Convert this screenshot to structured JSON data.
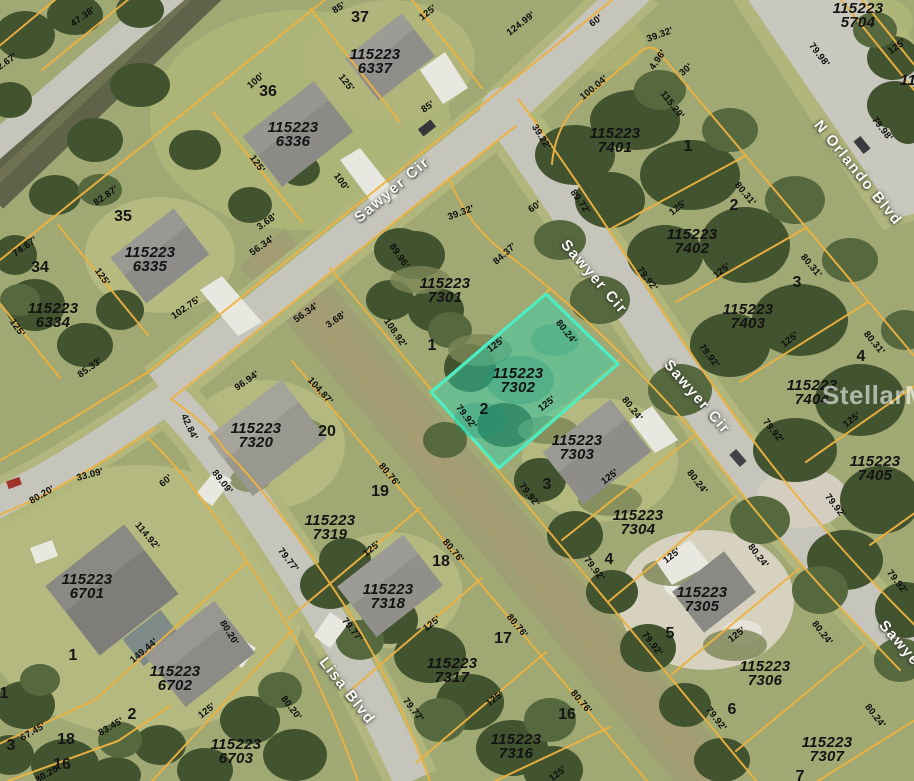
{
  "map": {
    "watermark": "StellarMLS",
    "highlighted_parcel": "115223 7302",
    "colors": {
      "parcel_line": "#eeb240",
      "highlight_fill": "rgba(45,212,180,0.45)",
      "highlight_border": "#49efc7",
      "road": "#c6c5bc"
    },
    "streets": [
      {
        "t": "Sawyer Cir",
        "x": 392,
        "y": 190,
        "r": -40
      },
      {
        "t": "Sawyer Cir",
        "x": 594,
        "y": 277,
        "r": 49
      },
      {
        "t": "Sawyer Cir",
        "x": 697,
        "y": 397,
        "r": 49
      },
      {
        "t": "Sawyer",
        "x": 902,
        "y": 646,
        "r": 49
      },
      {
        "t": "Lisa Blvd",
        "x": 347,
        "y": 691,
        "r": 52
      },
      {
        "t": "N Orlando Blvd",
        "x": 858,
        "y": 173,
        "r": 51
      }
    ],
    "parcel_ids": [
      {
        "t": "115223 6337",
        "x": 375,
        "y": 62
      },
      {
        "t": "115223 6336",
        "x": 293,
        "y": 135
      },
      {
        "t": "115223 6335",
        "x": 150,
        "y": 260
      },
      {
        "t": "115223 6334",
        "x": 53,
        "y": 316
      },
      {
        "t": "115223 5704",
        "x": 858,
        "y": 16
      },
      {
        "t": "11",
        "x": 908,
        "y": 81
      },
      {
        "t": "115223 7401",
        "x": 615,
        "y": 141
      },
      {
        "t": "115223 7402",
        "x": 692,
        "y": 242
      },
      {
        "t": "115223 7403",
        "x": 748,
        "y": 317
      },
      {
        "t": "115223 7404",
        "x": 812,
        "y": 393
      },
      {
        "t": "115223 7405",
        "x": 875,
        "y": 469
      },
      {
        "t": "115223 7301",
        "x": 445,
        "y": 291
      },
      {
        "t": "115223 7302",
        "x": 518,
        "y": 381
      },
      {
        "t": "115223 7303",
        "x": 577,
        "y": 448
      },
      {
        "t": "115223 7304",
        "x": 638,
        "y": 523
      },
      {
        "t": "115223 7305",
        "x": 702,
        "y": 600
      },
      {
        "t": "115223 7306",
        "x": 765,
        "y": 674
      },
      {
        "t": "115223 7307",
        "x": 827,
        "y": 750
      },
      {
        "t": "115223 7320",
        "x": 256,
        "y": 436
      },
      {
        "t": "115223 7319",
        "x": 330,
        "y": 528
      },
      {
        "t": "115223 7318",
        "x": 388,
        "y": 597
      },
      {
        "t": "115223 7317",
        "x": 452,
        "y": 671
      },
      {
        "t": "115223 7316",
        "x": 516,
        "y": 747
      },
      {
        "t": "115223 6701",
        "x": 87,
        "y": 587
      },
      {
        "t": "115223 6702",
        "x": 175,
        "y": 679
      },
      {
        "t": "115223 6703",
        "x": 236,
        "y": 752
      }
    ],
    "lot_numbers": [
      {
        "t": "37",
        "x": 360,
        "y": 18
      },
      {
        "t": "36",
        "x": 268,
        "y": 92
      },
      {
        "t": "35",
        "x": 123,
        "y": 217
      },
      {
        "t": "34",
        "x": 40,
        "y": 268
      },
      {
        "t": "1",
        "x": 688,
        "y": 147
      },
      {
        "t": "2",
        "x": 734,
        "y": 206
      },
      {
        "t": "3",
        "x": 797,
        "y": 283
      },
      {
        "t": "4",
        "x": 861,
        "y": 357
      },
      {
        "t": "1",
        "x": 432,
        "y": 346
      },
      {
        "t": "2",
        "x": 484,
        "y": 410
      },
      {
        "t": "3",
        "x": 547,
        "y": 485
      },
      {
        "t": "4",
        "x": 609,
        "y": 560
      },
      {
        "t": "5",
        "x": 670,
        "y": 634
      },
      {
        "t": "6",
        "x": 732,
        "y": 710
      },
      {
        "t": "7",
        "x": 800,
        "y": 777
      },
      {
        "t": "20",
        "x": 327,
        "y": 432
      },
      {
        "t": "19",
        "x": 380,
        "y": 492
      },
      {
        "t": "18",
        "x": 441,
        "y": 562
      },
      {
        "t": "17",
        "x": 503,
        "y": 639
      },
      {
        "t": "16",
        "x": 567,
        "y": 715
      },
      {
        "t": "1",
        "x": 73,
        "y": 656
      },
      {
        "t": "2",
        "x": 132,
        "y": 715
      },
      {
        "t": "18",
        "x": 66,
        "y": 740
      },
      {
        "t": "16",
        "x": 62,
        "y": 765
      },
      {
        "t": "3",
        "x": 11,
        "y": 746
      },
      {
        "t": "1",
        "x": 4,
        "y": 694
      }
    ],
    "measurements": [
      {
        "t": "47.38'",
        "x": 83,
        "y": 17,
        "r": -35
      },
      {
        "t": "2.67'",
        "x": 7,
        "y": 62,
        "r": -35
      },
      {
        "t": "85'",
        "x": 339,
        "y": 8,
        "r": -32
      },
      {
        "t": "125'",
        "x": 428,
        "y": 13,
        "r": -38
      },
      {
        "t": "124.99'",
        "x": 521,
        "y": 24,
        "r": -38
      },
      {
        "t": "60'",
        "x": 596,
        "y": 21,
        "r": -36
      },
      {
        "t": "39.32'",
        "x": 660,
        "y": 35,
        "r": -20
      },
      {
        "t": "100'",
        "x": 256,
        "y": 81,
        "r": -40
      },
      {
        "t": "125'",
        "x": 346,
        "y": 83,
        "r": 52
      },
      {
        "t": "85'",
        "x": 428,
        "y": 107,
        "r": -35
      },
      {
        "t": "100'",
        "x": 341,
        "y": 182,
        "r": 55
      },
      {
        "t": "125'",
        "x": 257,
        "y": 164,
        "r": 55
      },
      {
        "t": "82.87'",
        "x": 106,
        "y": 196,
        "r": -35
      },
      {
        "t": "3.68'",
        "x": 267,
        "y": 222,
        "r": -35
      },
      {
        "t": "56.34'",
        "x": 262,
        "y": 246,
        "r": -35
      },
      {
        "t": "74.67'",
        "x": 25,
        "y": 247,
        "r": -35
      },
      {
        "t": "125'",
        "x": 102,
        "y": 277,
        "r": 55
      },
      {
        "t": "102.75'",
        "x": 186,
        "y": 308,
        "r": -35
      },
      {
        "t": "125'",
        "x": 17,
        "y": 328,
        "r": 55
      },
      {
        "t": "85.33'",
        "x": 90,
        "y": 368,
        "r": -35
      },
      {
        "t": "56.34'",
        "x": 306,
        "y": 313,
        "r": -35
      },
      {
        "t": "3.68'",
        "x": 336,
        "y": 320,
        "r": -35
      },
      {
        "t": "4.96'",
        "x": 658,
        "y": 60,
        "r": -55
      },
      {
        "t": "30'",
        "x": 686,
        "y": 70,
        "r": -40
      },
      {
        "t": "115.29'",
        "x": 672,
        "y": 105,
        "r": 52
      },
      {
        "t": "100.04'",
        "x": 594,
        "y": 88,
        "r": -40
      },
      {
        "t": "39.22'",
        "x": 541,
        "y": 137,
        "r": 58
      },
      {
        "t": "89.72'",
        "x": 580,
        "y": 202,
        "r": 55
      },
      {
        "t": "60'",
        "x": 535,
        "y": 207,
        "r": -35
      },
      {
        "t": "79.98'",
        "x": 819,
        "y": 55,
        "r": 52
      },
      {
        "t": "79.98'",
        "x": 882,
        "y": 129,
        "r": 52
      },
      {
        "t": "125'",
        "x": 897,
        "y": 47,
        "r": -35
      },
      {
        "t": "80.31'",
        "x": 745,
        "y": 194,
        "r": 50
      },
      {
        "t": "125'",
        "x": 678,
        "y": 208,
        "r": -38
      },
      {
        "t": "80.31'",
        "x": 811,
        "y": 266,
        "r": 50
      },
      {
        "t": "125'",
        "x": 722,
        "y": 271,
        "r": -38
      },
      {
        "t": "80.31'",
        "x": 874,
        "y": 343,
        "r": 50
      },
      {
        "t": "125'",
        "x": 790,
        "y": 340,
        "r": -38
      },
      {
        "t": "125'",
        "x": 852,
        "y": 420,
        "r": -38
      },
      {
        "t": "79.92'",
        "x": 647,
        "y": 279,
        "r": 52
      },
      {
        "t": "79.92'",
        "x": 709,
        "y": 356,
        "r": 52
      },
      {
        "t": "79.92'",
        "x": 773,
        "y": 431,
        "r": 52
      },
      {
        "t": "79.92'",
        "x": 835,
        "y": 506,
        "r": 52
      },
      {
        "t": "79.92'",
        "x": 897,
        "y": 582,
        "r": 52
      },
      {
        "t": "39.32'",
        "x": 461,
        "y": 213,
        "r": -20
      },
      {
        "t": "84.37'",
        "x": 505,
        "y": 254,
        "r": -42
      },
      {
        "t": "89.96'",
        "x": 399,
        "y": 256,
        "r": 55
      },
      {
        "t": "108.92'",
        "x": 395,
        "y": 333,
        "r": 55
      },
      {
        "t": "125'",
        "x": 496,
        "y": 345,
        "r": -38
      },
      {
        "t": "80.24'",
        "x": 566,
        "y": 332,
        "r": 52
      },
      {
        "t": "79.92'",
        "x": 466,
        "y": 417,
        "r": 52
      },
      {
        "t": "125'",
        "x": 547,
        "y": 404,
        "r": -38
      },
      {
        "t": "80.24'",
        "x": 632,
        "y": 409,
        "r": 52
      },
      {
        "t": "125'",
        "x": 610,
        "y": 477,
        "r": -38
      },
      {
        "t": "79.92'",
        "x": 529,
        "y": 495,
        "r": 52
      },
      {
        "t": "80.24'",
        "x": 697,
        "y": 482,
        "r": 52
      },
      {
        "t": "125'",
        "x": 672,
        "y": 556,
        "r": -38
      },
      {
        "t": "79.92'",
        "x": 594,
        "y": 569,
        "r": 52
      },
      {
        "t": "80.24'",
        "x": 758,
        "y": 556,
        "r": 52
      },
      {
        "t": "125'",
        "x": 737,
        "y": 635,
        "r": -38
      },
      {
        "t": "79.92'",
        "x": 652,
        "y": 644,
        "r": 52
      },
      {
        "t": "80.24'",
        "x": 822,
        "y": 633,
        "r": 52
      },
      {
        "t": "79.92'",
        "x": 716,
        "y": 719,
        "r": 52
      },
      {
        "t": "80.24'",
        "x": 875,
        "y": 716,
        "r": 52
      },
      {
        "t": "96.94'",
        "x": 247,
        "y": 381,
        "r": -35
      },
      {
        "t": "104.87'",
        "x": 320,
        "y": 391,
        "r": 48
      },
      {
        "t": "42.84'",
        "x": 189,
        "y": 427,
        "r": 65
      },
      {
        "t": "89.09'",
        "x": 222,
        "y": 482,
        "r": 52
      },
      {
        "t": "80.76'",
        "x": 389,
        "y": 475,
        "r": 50
      },
      {
        "t": "125'",
        "x": 372,
        "y": 549,
        "r": -38
      },
      {
        "t": "79.77'",
        "x": 288,
        "y": 560,
        "r": 52
      },
      {
        "t": "80.76'",
        "x": 453,
        "y": 551,
        "r": 50
      },
      {
        "t": "125'",
        "x": 432,
        "y": 624,
        "r": -38
      },
      {
        "t": "79.77'",
        "x": 352,
        "y": 630,
        "r": 52
      },
      {
        "t": "80.76'",
        "x": 517,
        "y": 626,
        "r": 50
      },
      {
        "t": "125'",
        "x": 495,
        "y": 699,
        "r": -38
      },
      {
        "t": "79.77'",
        "x": 413,
        "y": 710,
        "r": 52
      },
      {
        "t": "80.76'",
        "x": 581,
        "y": 702,
        "r": 50
      },
      {
        "t": "125'",
        "x": 558,
        "y": 774,
        "r": -38
      },
      {
        "t": "33.09'",
        "x": 90,
        "y": 475,
        "r": -15
      },
      {
        "t": "80.20'",
        "x": 42,
        "y": 495,
        "r": -30
      },
      {
        "t": "60'",
        "x": 166,
        "y": 481,
        "r": -40
      },
      {
        "t": "114.92'",
        "x": 147,
        "y": 536,
        "r": 50
      },
      {
        "t": "149.44'",
        "x": 144,
        "y": 651,
        "r": -40
      },
      {
        "t": "80.20'",
        "x": 229,
        "y": 633,
        "r": 58
      },
      {
        "t": "125'",
        "x": 207,
        "y": 711,
        "r": -38
      },
      {
        "t": "83.45'",
        "x": 111,
        "y": 727,
        "r": -30
      },
      {
        "t": "67.45'",
        "x": 33,
        "y": 732,
        "r": -30
      },
      {
        "t": "80.20'",
        "x": 291,
        "y": 708,
        "r": 52
      },
      {
        "t": "80.20'",
        "x": 48,
        "y": 774,
        "r": -30
      }
    ]
  }
}
